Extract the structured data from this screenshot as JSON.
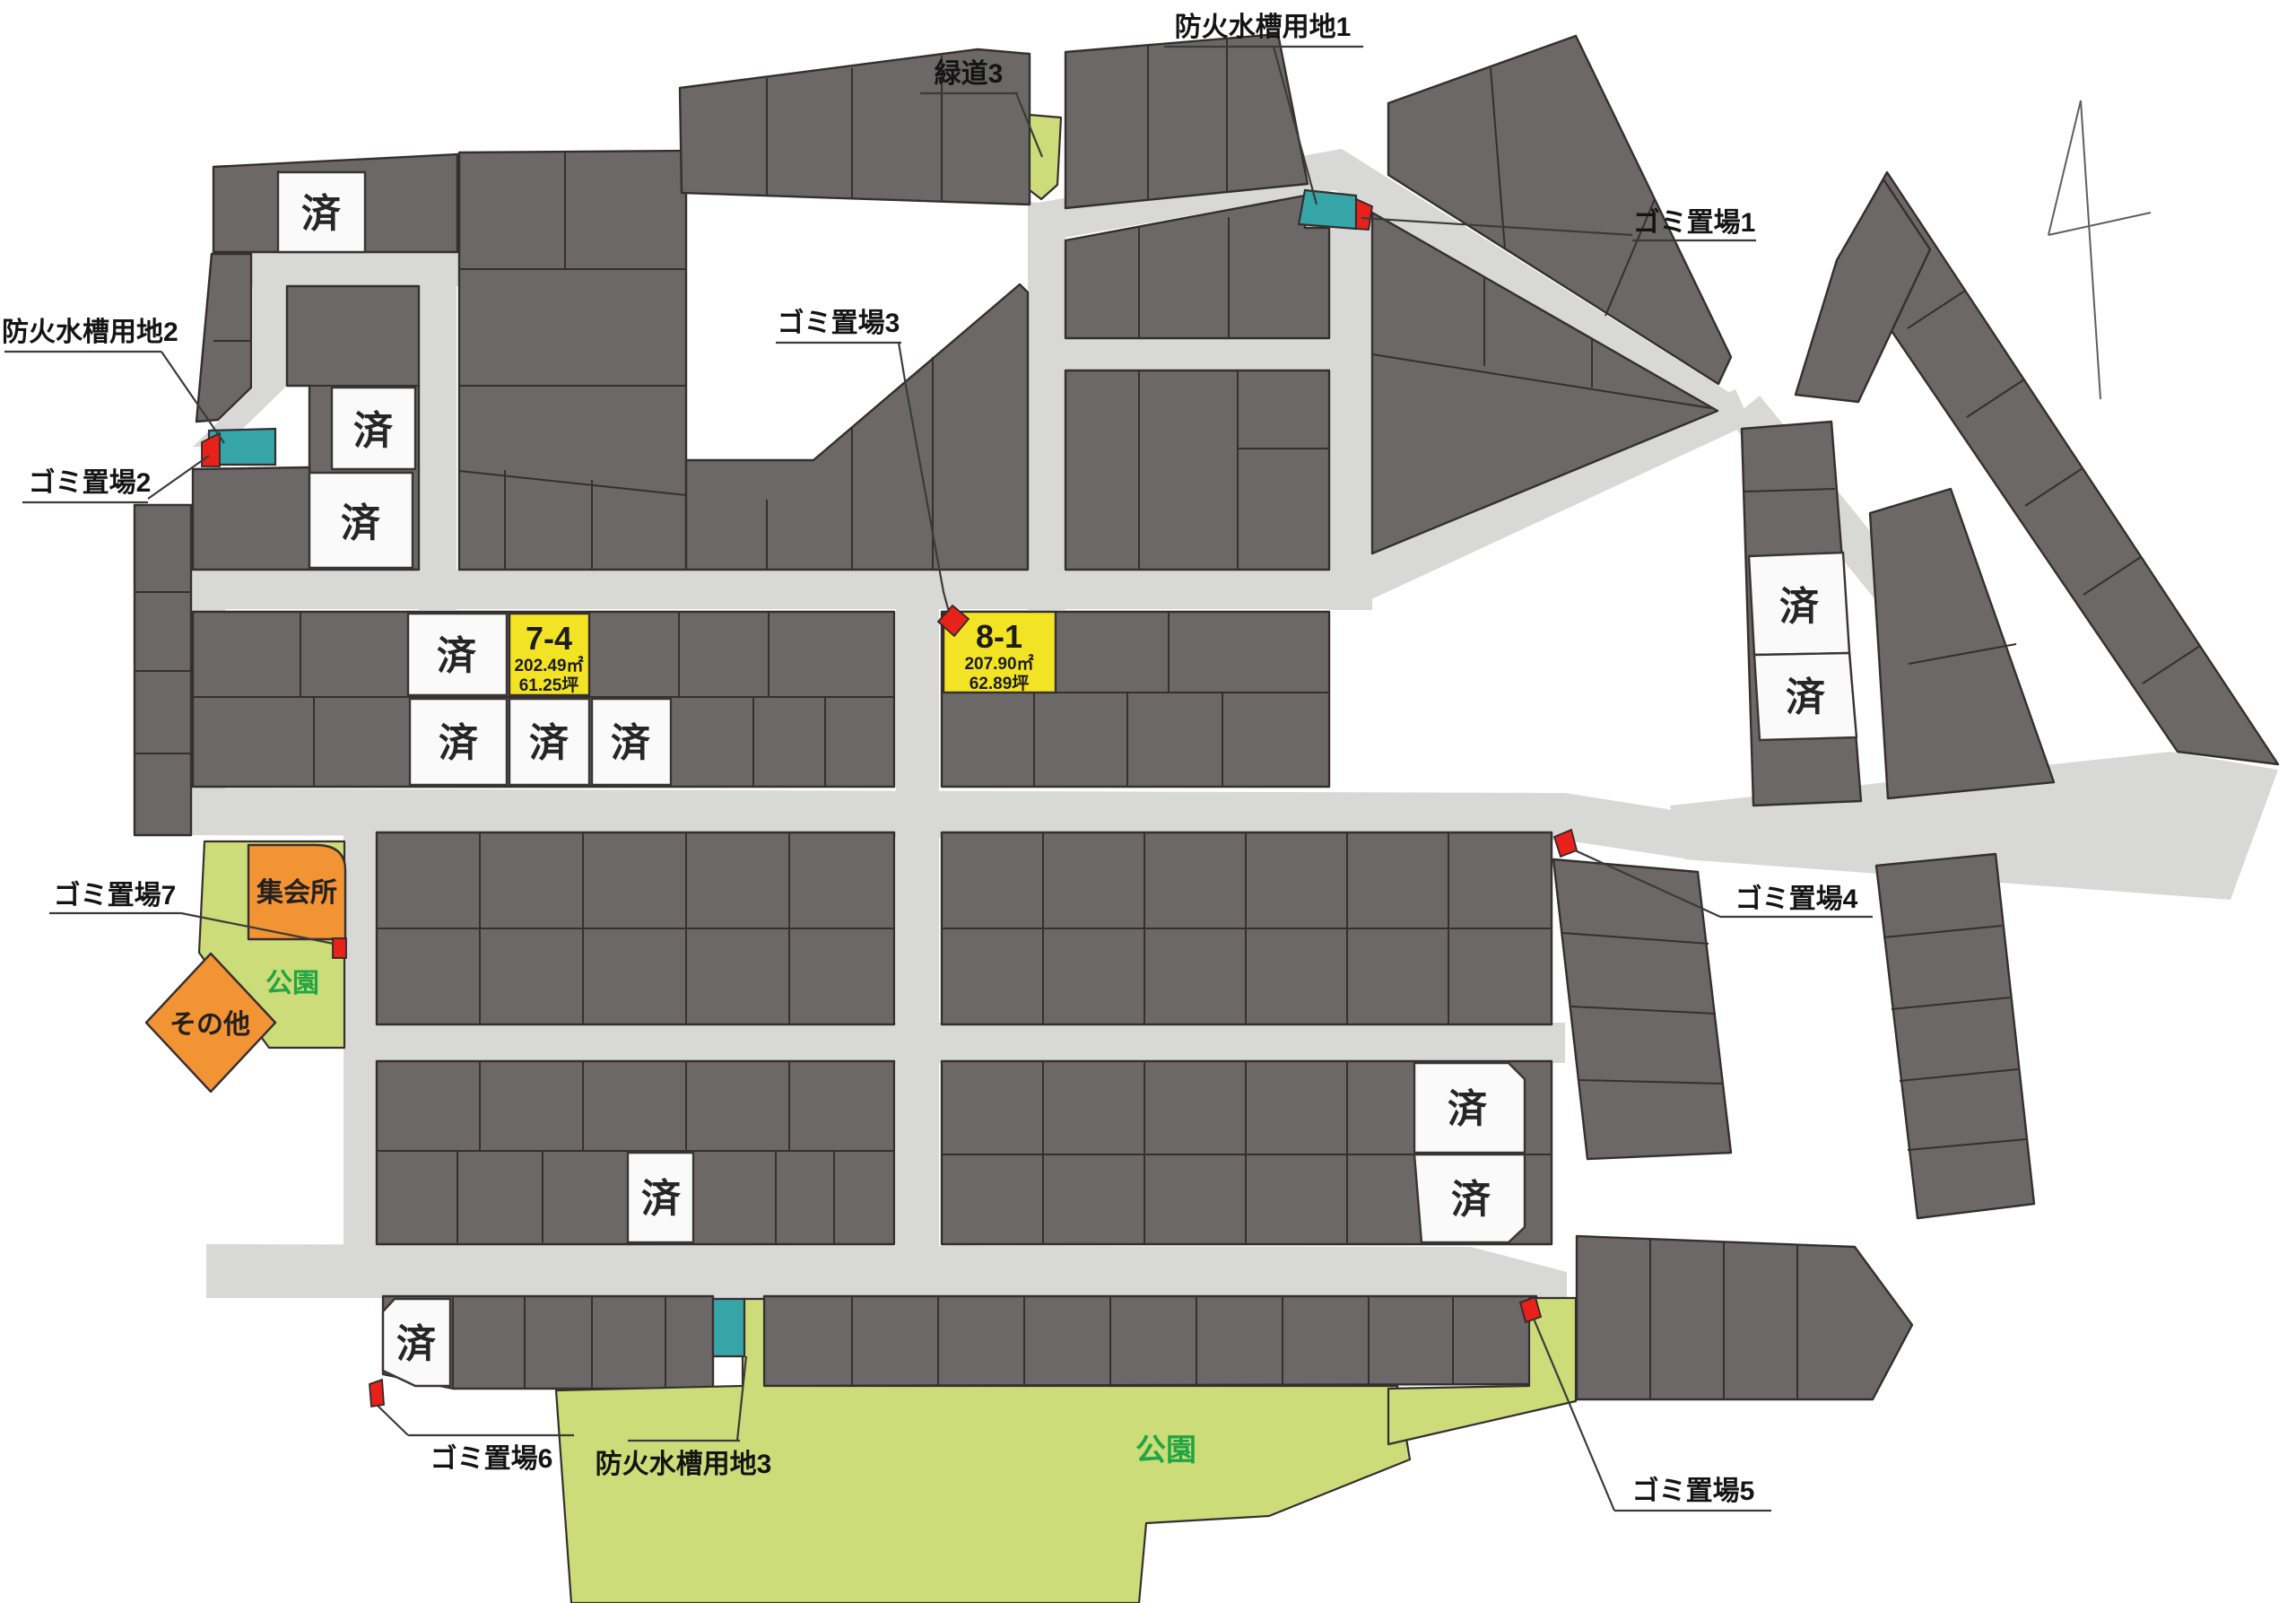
{
  "map": {
    "type": "residential-subdivision-site-plan",
    "sold_label": "済",
    "callouts": {
      "fire1": "防火水槽用地1",
      "green3": "緑道3",
      "trash1": "ゴミ置場1",
      "fire2": "防火水槽用地2",
      "trash2": "ゴミ置場2",
      "trash3": "ゴミ置場3",
      "trash4": "ゴミ置場4",
      "trash5": "ゴミ置場5",
      "trash6": "ゴミ置場6",
      "fire3": "防火水槽用地3",
      "trash7": "ゴミ置場7"
    },
    "areas": {
      "hall": "集会所",
      "other": "その他",
      "park": "公園"
    },
    "featured_lots": {
      "lot74": {
        "no": "7-4",
        "area": "202.49㎡",
        "tsubo": "61.25坪"
      },
      "lot81": {
        "no": "8-1",
        "area": "207.90㎡",
        "tsubo": "62.89坪"
      }
    },
    "colors": {
      "lot_dark": "#6c6868",
      "road": "#d8d8d6",
      "sold_lot": "#fafafa",
      "available_lot": "#f2e324",
      "fire_tank": "#35a5a8",
      "trash_marker": "#e8211a",
      "facility": "#f29334",
      "park": "#cbdc78",
      "park_text": "#21a544",
      "outline": "#362f2f"
    }
  }
}
